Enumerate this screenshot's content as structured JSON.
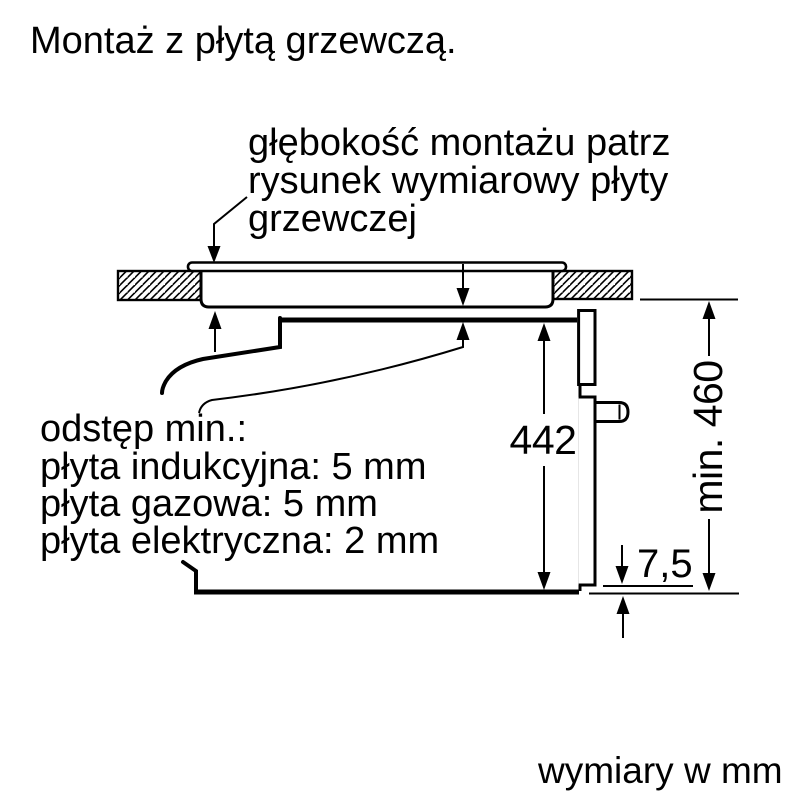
{
  "title": "Montaż z płytą grzewczą.",
  "footer": "wymiary w mm",
  "annotation": {
    "lines": {
      "0": "głębokość montażu patrz",
      "1": "rysunek wymiarowy płyty",
      "2": "grzewczej"
    }
  },
  "clearance_note": {
    "lines": {
      "0": "odstęp min.:",
      "1": "płyta indukcyjna: 5 mm",
      "2": "płyta gazowa: 5 mm",
      "3": "płyta elektryczna: 2 mm"
    }
  },
  "dimensions": {
    "oven_height": "442",
    "niche_height": "min. 460",
    "bottom_offset": "7,5"
  },
  "colors": {
    "line": "#000000",
    "background": "#ffffff"
  }
}
